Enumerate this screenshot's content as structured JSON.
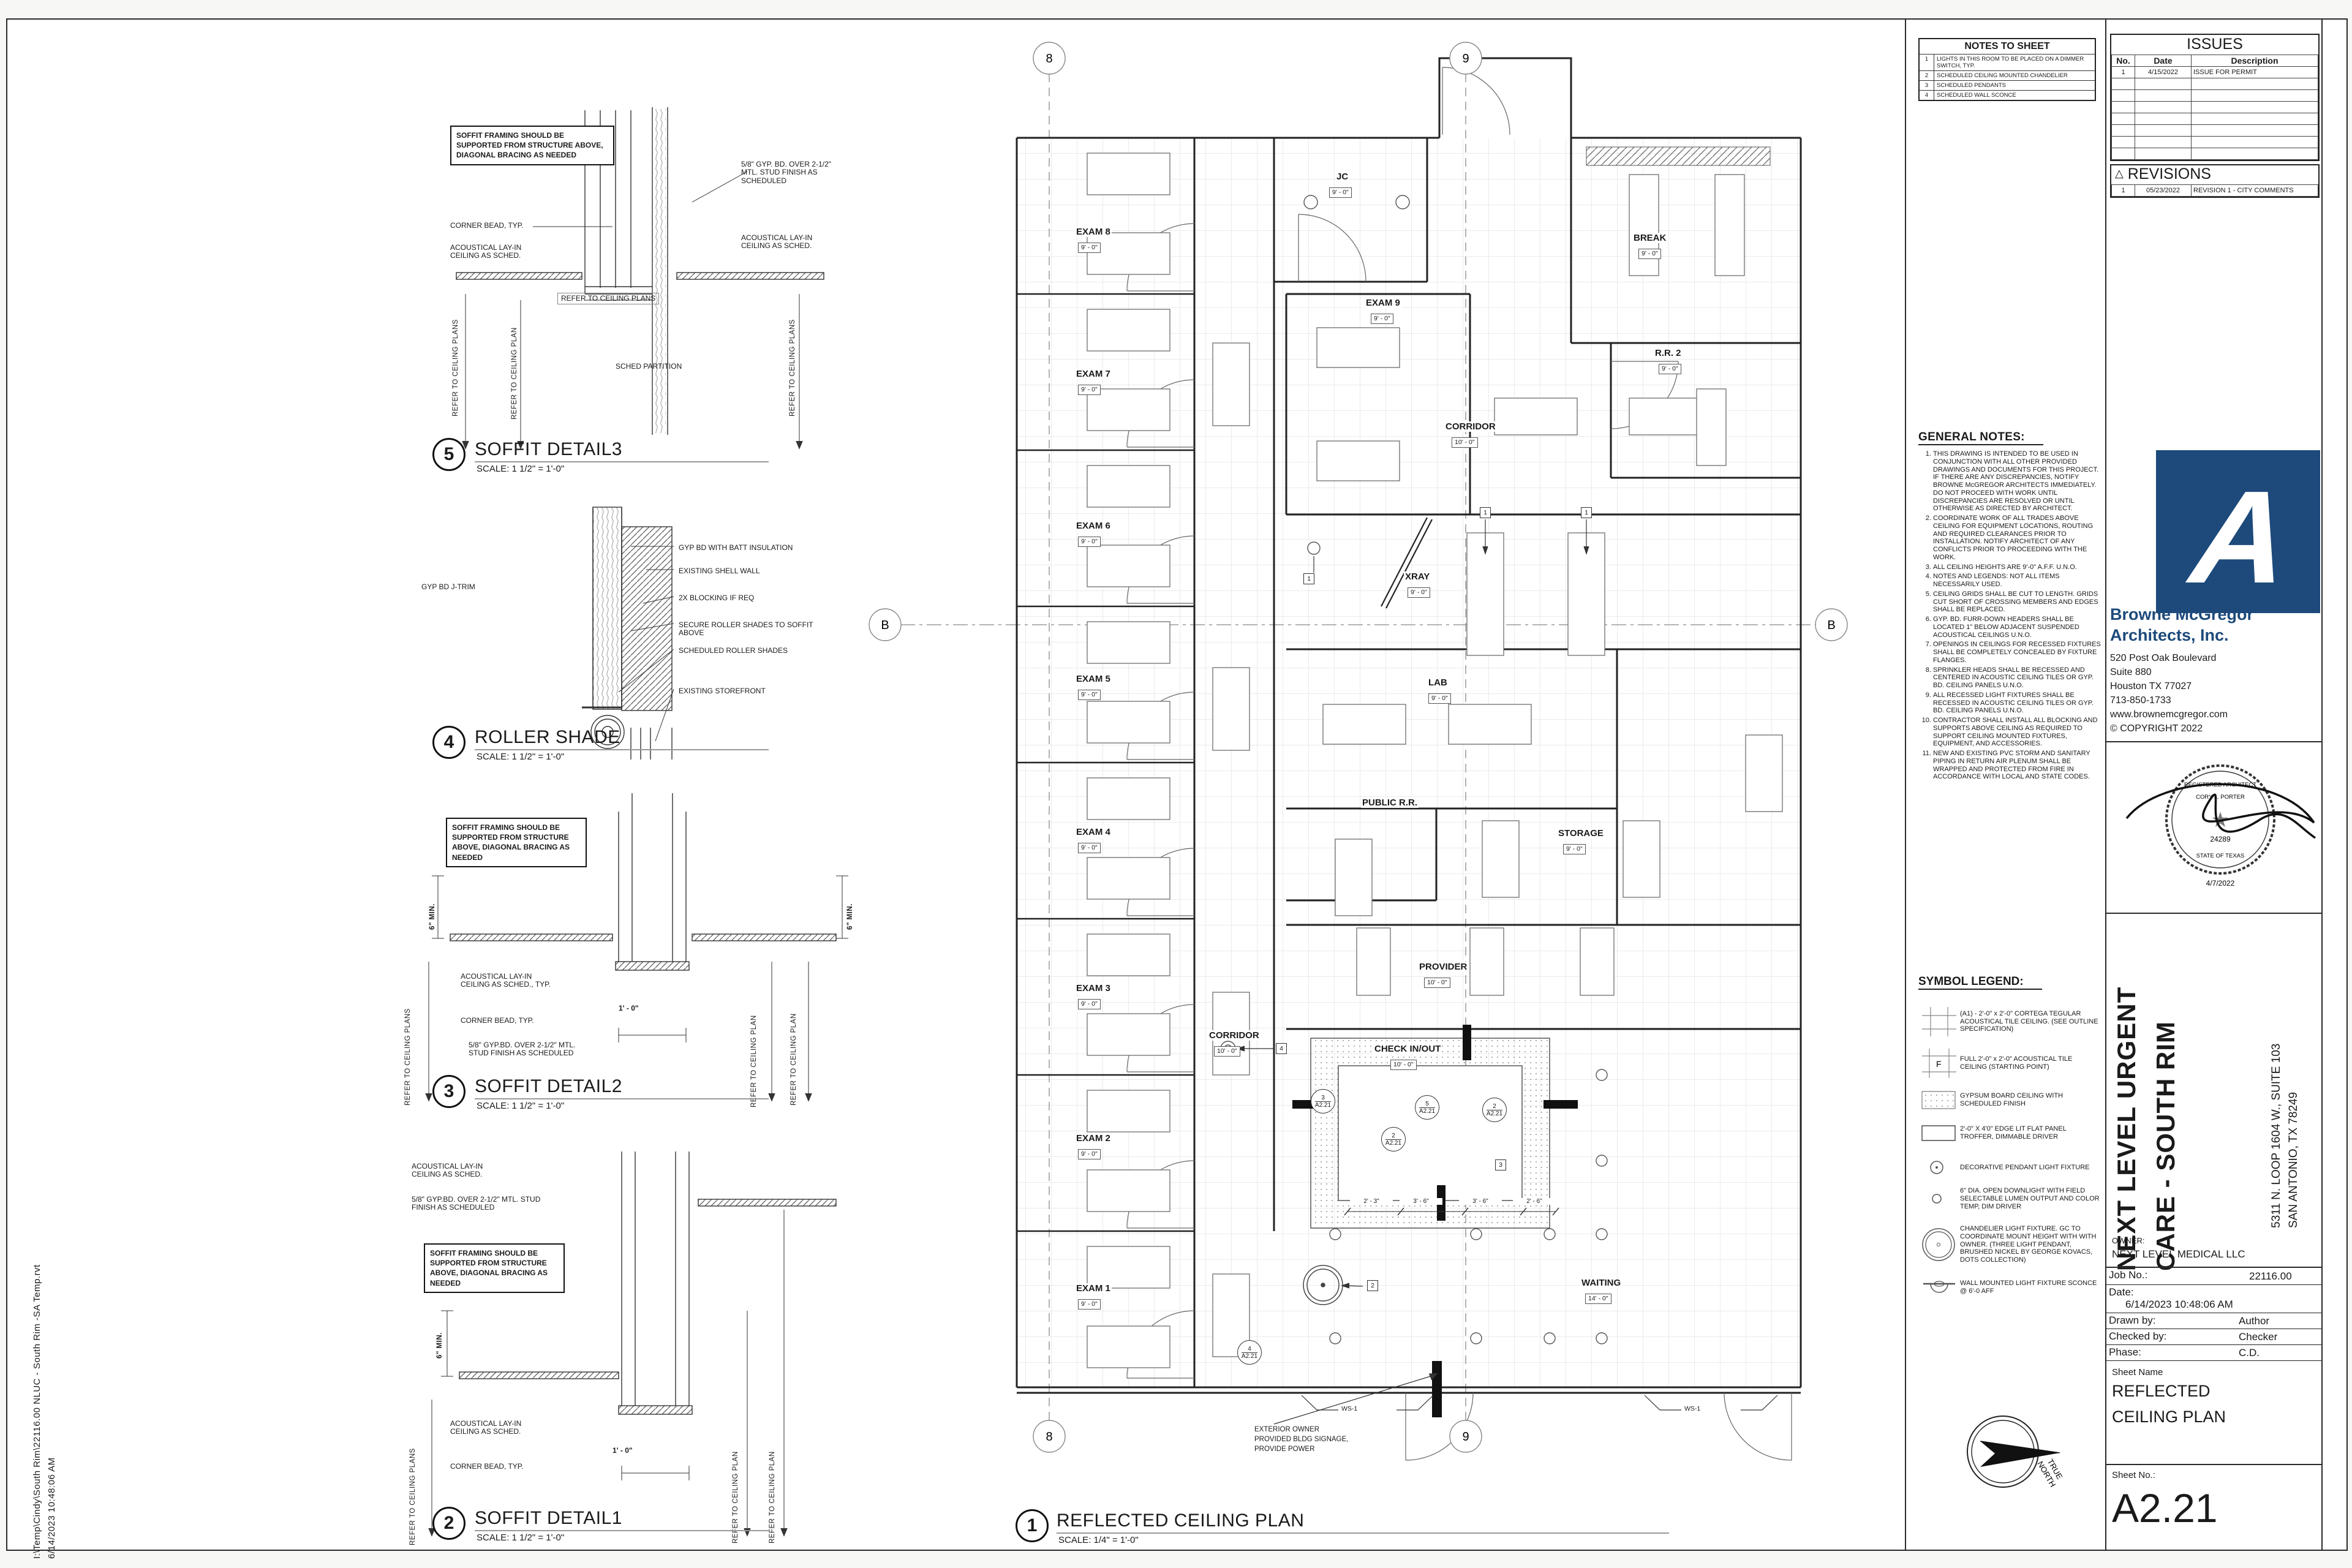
{
  "file_strip": {
    "path": "I:\\Temp\\Cindy\\South Rim\\22116.00 NLUC - South Rim -SA Temp.rvt",
    "datetime": "6/14/2023 10:48:06 AM"
  },
  "details": {
    "d5": {
      "num": "5",
      "title": "SOFFIT DETAIL3",
      "scale": "SCALE:  1 1/2\" = 1'-0\"",
      "notes": {
        "box": "SOFFIT FRAMING SHOULD BE SUPPORTED FROM STRUCTURE ABOVE, DIAGONAL BRACING AS NEEDED",
        "corner": "CORNER BEAD, TYP.",
        "acl_left": "ACOUSTICAL LAY-IN CEILING AS SCHED.",
        "gyp": "5/8\" GYP. BD. OVER 2-1/2\" MTL. STUD FINISH AS SCHEDULED",
        "acl_right": "ACOUSTICAL LAY-IN CEILING AS SCHED.",
        "refer_plans": "REFER TO CEILING PLANS",
        "refer_plan": "REFER TO CEILING PLAN",
        "refer_h": "REFER TO CEILING PLANS",
        "partition": "SCHED PARTITION"
      }
    },
    "d4": {
      "num": "4",
      "title": "ROLLER SHADE",
      "scale": "SCALE:  1 1/2\" = 1'-0\"",
      "notes": {
        "jtrim": "GYP BD J-TRIM",
        "batt": "GYP BD WITH BATT INSULATION",
        "shell": "EXISTING SHELL WALL",
        "blocking": "2X BLOCKING IF REQ",
        "secure": "SECURE ROLLER SHADES TO SOFFIT ABOVE",
        "sched": "SCHEDULED ROLLER SHADES",
        "storefront": "EXISTING STOREFRONT"
      }
    },
    "d3": {
      "num": "3",
      "title": "SOFFIT DETAIL2",
      "scale": "SCALE:  1 1/2\" = 1'-0\"",
      "notes": {
        "box": "SOFFIT FRAMING SHOULD BE SUPPORTED FROM STRUCTURE ABOVE, DIAGONAL BRACING AS NEEDED",
        "min": "6\" MIN.",
        "acl": "ACOUSTICAL LAY-IN CEILING AS SCHED., TYP.",
        "corner": "CORNER BEAD, TYP.",
        "gyp": "5/8\" GYP.BD. OVER 2-1/2\" MTL. STUD FINISH AS SCHEDULED",
        "dim": "1' - 0\"",
        "refer_plans": "REFER TO CEILING PLANS",
        "refer_plan": "REFER TO CEILING PLAN"
      }
    },
    "d2": {
      "num": "2",
      "title": "SOFFIT DETAIL1",
      "scale": "SCALE:  1 1/2\" = 1'-0\"",
      "notes": {
        "acl_top": "ACOUSTICAL LAY-IN CEILING AS SCHED.",
        "gyp": "5/8\" GYP.BD. OVER 2-1/2\" MTL. STUD FINISH AS SCHEDULED",
        "box": "SOFFIT FRAMING SHOULD BE SUPPORTED FROM STRUCTURE ABOVE, DIAGONAL BRACING AS NEEDED",
        "min": "6\" MIN.",
        "acl": "ACOUSTICAL LAY-IN CEILING AS SCHED.",
        "corner": "CORNER BEAD, TYP.",
        "dim": "1' - 0\"",
        "refer_plans": "REFER TO CEILING PLANS",
        "refer_plan": "REFER TO CEILING PLAN"
      }
    }
  },
  "plan": {
    "num": "1",
    "title": "REFLECTED CEILING PLAN",
    "scale": "SCALE:  1/4\" = 1'-0\"",
    "grid": {
      "c8": "8",
      "c9": "9",
      "rb": "B"
    },
    "h9": "9' - 0\"",
    "h10": "10' - 0\"",
    "h14": "14' - 0\"",
    "rooms": {
      "exam1": "EXAM 1",
      "exam2": "EXAM 2",
      "exam3": "EXAM 3",
      "exam4": "EXAM 4",
      "exam5": "EXAM 5",
      "exam6": "EXAM 6",
      "exam7": "EXAM 7",
      "exam8": "EXAM 8",
      "exam9": "EXAM 9",
      "jc": "JC",
      "brk": "BREAK",
      "rr2": "R.R. 2",
      "corridor": "CORRIDOR",
      "xray": "XRAY",
      "lab": "LAB",
      "public_rr": "PUBLIC R.R.",
      "storage": "STORAGE",
      "provider": "PROVIDER",
      "check": "CHECK IN/OUT",
      "waiting": "WAITING"
    },
    "tags": {
      "t1": "1",
      "t2": "2",
      "t3": "3",
      "t4": "4"
    },
    "callout_sheet": "A2.21",
    "callouts": {
      "c2": "2",
      "c3": "3",
      "c4": "4",
      "c5": "5"
    },
    "dims": {
      "d1": "2' - 3\"",
      "d2": "3' - 6\"",
      "d3": "3' - 6\"",
      "d4": "2' - 6\""
    },
    "ws1": "WS-1",
    "signage1": "EXTERIOR OWNER",
    "signage2": "PROVIDED BLDG SIGNAGE,",
    "signage3": "PROVIDE POWER",
    "north1": "TRUE",
    "north2": "NORTH"
  },
  "notes_to_sheet": {
    "title": "NOTES TO SHEET",
    "rows": [
      {
        "no": "1",
        "text": "LIGHTS IN THIS ROOM TO BE PLACED ON A DIMMER SWITCH, TYP."
      },
      {
        "no": "2",
        "text": "SCHEDULED CEILING MOUNTED CHANDELIER"
      },
      {
        "no": "3",
        "text": "SCHEDULED PENDANTS"
      },
      {
        "no": "4",
        "text": "SCHEDULED WALL SCONCE"
      }
    ]
  },
  "general_notes": {
    "title": "GENERAL NOTES:",
    "items": [
      "THIS DRAWING IS INTENDED TO BE USED IN CONJUNCTION WITH ALL OTHER PROVIDED DRAWINGS AND DOCUMENTS FOR THIS PROJECT. IF THERE ARE ANY DISCREPANCIES, NOTIFY BROWNE McGREGOR ARCHITECTS IMMEDIATELY. DO NOT PROCEED WITH WORK UNTIL DISCREPANCIES ARE RESOLVED OR UNTIL OTHERWISE AS DIRECTED BY ARCHITECT.",
      "COORDINATE WORK OF ALL TRADES ABOVE CEILING FOR EQUIPMENT LOCATIONS, ROUTING AND REQUIRED CLEARANCES PRIOR TO INSTALLATION. NOTIFY ARCHITECT OF ANY CONFLICTS PRIOR TO PROCEEDING WITH THE WORK.",
      "ALL CEILING HEIGHTS ARE 9'-0\" A.F.F. U.N.O.",
      "NOTES AND LEGENDS: NOT ALL ITEMS NECESSARILY USED.",
      "CEILING GRIDS SHALL BE CUT TO LENGTH.  GRIDS CUT SHORT OF CROSSING MEMBERS AND EDGES SHALL BE REPLACED.",
      "GYP. BD. FURR-DOWN HEADERS SHALL BE LOCATED 1\" BELOW ADJACENT SUSPENDED ACOUSTICAL CEILINGS U.N.O.",
      "OPENINGS IN CEILINGS FOR RECESSED FIXTURES SHALL BE COMPLETELY CONCEALED BY FIXTURE FLANGES.",
      "SPRINKLER HEADS SHALL BE RECESSED AND CENTERED IN ACOUSTIC CEILING TILES OR GYP. BD. CEILING PANELS U.N.O.",
      "ALL RECESSED LIGHT FIXTURES SHALL BE RECESSED IN ACOUSTIC CEILING TILES OR GYP. BD. CEILING PANELS U.N.O.",
      "CONTRACTOR SHALL INSTALL ALL BLOCKING AND SUPPORTS ABOVE CEILING AS REQUIRED TO SUPPORT CEILING MOUNTED FIXTURES, EQUIPMENT, AND ACCESSORIES.",
      "NEW AND EXISTING PVC STORM AND SANITARY PIPING IN RETURN AIR PLENUM SHALL BE WRAPPED AND PROTECTED FROM FIRE IN ACCORDANCE WITH LOCAL AND STATE CODES."
    ]
  },
  "symbol_legend": {
    "title": "SYMBOL LEGEND:",
    "f": "F",
    "items": [
      "(A1) - 2'-0\" x 2'-0\" CORTEGA TEGULAR ACOUSTICAL TILE CEILING. (SEE OUTLINE SPECIFICATION)",
      "FULL 2'-0\" x 2'-0\" ACOUSTICAL TILE CEILING (STARTING POINT)",
      "GYPSUM BOARD CEILING WITH SCHEDULED FINISH",
      "2'-0\" X 4'0\" EDGE LIT FLAT PANEL TROFFER, DIMMABLE DRIVER",
      "DECORATIVE PENDANT LIGHT FIXTURE",
      "6\" DIA. OPEN DOWNLIGHT WITH FIELD SELECTABLE LUMEN OUTPUT AND COLOR TEMP, DIM DRIVER",
      "CHANDELIER LIGHT FIXTURE.  GC TO COORDINATE MOUNT HEIGHT WITH WITH OWNER.  (THREE LIGHT PENDANT, BRUSHED NICKEL BY GEORGE KOVACS, DOTS COLLECTION)",
      "WALL MOUNTED LIGHT FIXTURE SCONCE @ 6'-0 AFF"
    ]
  },
  "titleblock": {
    "issues": {
      "title": "ISSUES",
      "headers": {
        "no": "No.",
        "date": "Date",
        "desc": "Description"
      },
      "row1": {
        "no": "1",
        "date": "4/15/2022",
        "desc": "ISSUE FOR PERMIT"
      }
    },
    "revisions": {
      "tri": "△",
      "title": "REVISIONS",
      "row": {
        "no": "1",
        "date": "05/23/2022",
        "desc": "REVISION 1 - CITY COMMENTS"
      }
    },
    "firm": {
      "logo_a": "A",
      "name1": "Browne McGregor",
      "name2": "Architects, Inc.",
      "addr1": "520 Post Oak Boulevard",
      "addr2": "Suite 880",
      "addr3": "Houston TX 77027",
      "phone": "713-850-1733",
      "web": "www.brownemcgregor.com",
      "copyright": "© COPYRIGHT  2022",
      "accent": "#1d4a7b"
    },
    "seal": {
      "l1": "REGISTERED ARCHITECT",
      "l2": "CORY L. PORTER",
      "star": "★",
      "l3": "24289",
      "l4": "STATE OF TEXAS",
      "date": "4/7/2022"
    },
    "project": {
      "name1": "NEXT LEVEL URGENT",
      "name2": "CARE - SOUTH RIM",
      "addr1": "5311 N. LOOP 1604 W., SUITE 103",
      "addr2": "SAN ANTONIO, TX 78249",
      "owner_label": "OWNER:",
      "owner": "NEXT LEVEL MEDICAL LLC"
    },
    "meta": {
      "job_label": "Job No.:",
      "job": "22116.00",
      "date_label": "Date:",
      "date": "6/14/2023 10:48:06 AM",
      "drawn_label": "Drawn by:",
      "drawn": "Author",
      "checked_label": "Checked by:",
      "checked": "Checker",
      "phase_label": "Phase:",
      "phase": "C.D.",
      "sheetname_label": "Sheet Name",
      "sheetname1": "REFLECTED",
      "sheetname2": "CEILING PLAN",
      "sheetno_label": "Sheet No.:",
      "sheetno": "A2.21"
    }
  }
}
